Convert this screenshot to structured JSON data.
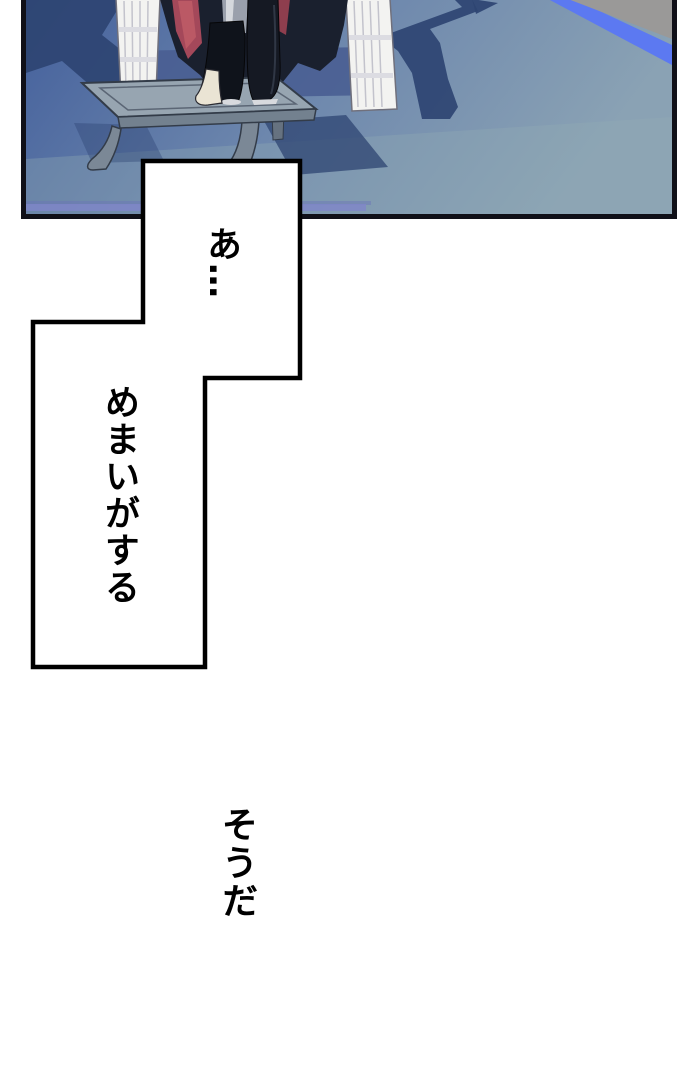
{
  "page": {
    "background": "#ffffff"
  },
  "panel": {
    "border_color": "#101018",
    "colors": {
      "floor_left": "#44609c",
      "floor_mid": "#6d87ad",
      "floor_right": "#8aa2b4",
      "floor_light_band": "#93abb4",
      "floor_violet_edge": "#7f86c9",
      "shadow_navy": "#2e4472",
      "behind_stool_blue": "#495e92",
      "dais_stripe_blue": "#5c79f1",
      "corner_gray": "#9a9998",
      "stool_top_gray": "#97a5b1",
      "stool_front_gray": "#73818f",
      "stool_leg_gray": "#7b8896",
      "pillar_white": "#f3f3f1",
      "cape_dark": "#1a202e",
      "cape_lining_red": "#a4485a",
      "trouser_gray": "#9aa0ac",
      "boot_black": "#151923",
      "boot_trim_white": "#eae4d4"
    }
  },
  "speech": {
    "bubble_fill": "#ffffff",
    "bubble_stroke": "#000000",
    "bubble_1_text": "あ…",
    "bubble_2_text": "めまいがする",
    "narration_text": "そうだ"
  }
}
